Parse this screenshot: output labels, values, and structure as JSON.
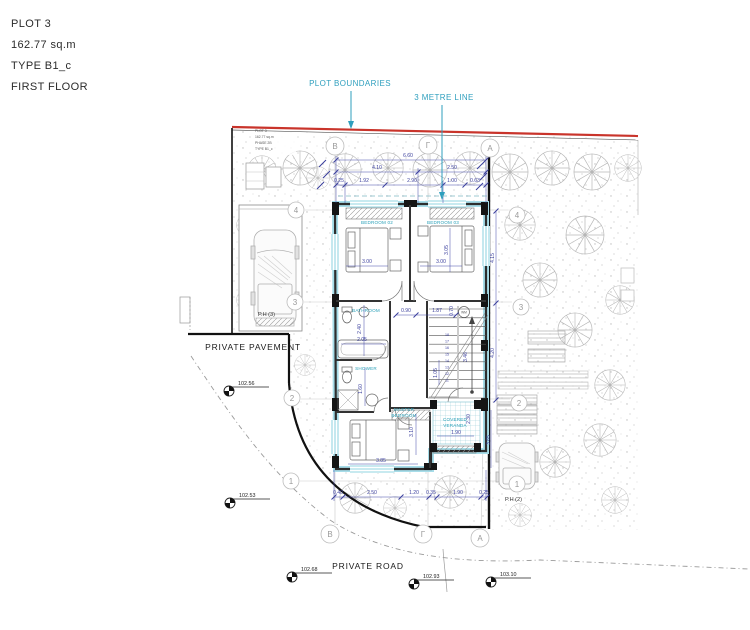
{
  "title_block": {
    "plot": "PLOT 3",
    "area": "162.77 sq.m",
    "type": "TYPE B1_c",
    "floor": "FIRST FLOOR"
  },
  "callouts": {
    "plot_boundaries": "PLOT BOUNDARIES",
    "three_metre_line": "3 METRE LINE"
  },
  "site": {
    "private_pavement": "PRIVATE PAVEMENT",
    "private_road": "PRIVATE ROAD",
    "parking_house_3": "P.H (3)",
    "parking_house_2": "P.H (2)"
  },
  "plot_tag": {
    "line1": "PLOT 3",
    "line2": "162.77 sq.m",
    "line3": "PHASE 2B",
    "line4": "TYPE B1_c"
  },
  "rooms": {
    "bedroom02": "BEDROOM 02",
    "bedroom03": "BEDROOM 03",
    "bathroom": "BATHROOM",
    "shower": "SHOWER",
    "master_line1": "MASTER",
    "master_line2": "BEDROOM",
    "veranda_line1": "COVERED",
    "veranda_line2": "VERANDA",
    "washing_machine": "WM"
  },
  "grid": {
    "top": [
      "B",
      "Γ",
      "A"
    ],
    "bottom": [
      "B",
      "Γ",
      "A"
    ],
    "left": [
      "4",
      "3",
      "2",
      "1"
    ],
    "right": [
      "4",
      "3",
      "2",
      "1"
    ]
  },
  "levels": {
    "pavement_upper": "102.56",
    "pavement_lower": "102.53",
    "road_left": "102.68",
    "road_mid": "102.93",
    "road_right": "103.10"
  },
  "dims": {
    "overall_top": "6.60",
    "top_row2": [
      "4.10",
      "2.50"
    ],
    "top_row3": [
      "0.25",
      "1.92",
      "2.90",
      "1.00",
      "0.63"
    ],
    "right_chain": [
      "4.15",
      "4.20"
    ],
    "bottom_row": [
      "0.40",
      "2.50",
      "1.20",
      "0.35",
      "1.90",
      "0.25"
    ],
    "bedroom02_w": "3.00",
    "bedroom03_w": "3.00",
    "bedroom03_h": "3.05",
    "hall_a": "0.90",
    "hall_b": "1.87",
    "stair_top": "0.70",
    "bathroom_h": "2.40",
    "bathroom_w": "2.05",
    "shower_h": "1.60",
    "stair_mid": "1.05",
    "stair_side": "3.46",
    "master_h": "3.10",
    "master_w": "3.85",
    "veranda_w": "1.90",
    "veranda_h": "2.30",
    "side_right": "3.65"
  },
  "stairs": {
    "numbers": [
      "18",
      "17",
      "16",
      "15",
      "14",
      "13",
      "12",
      "11"
    ]
  }
}
